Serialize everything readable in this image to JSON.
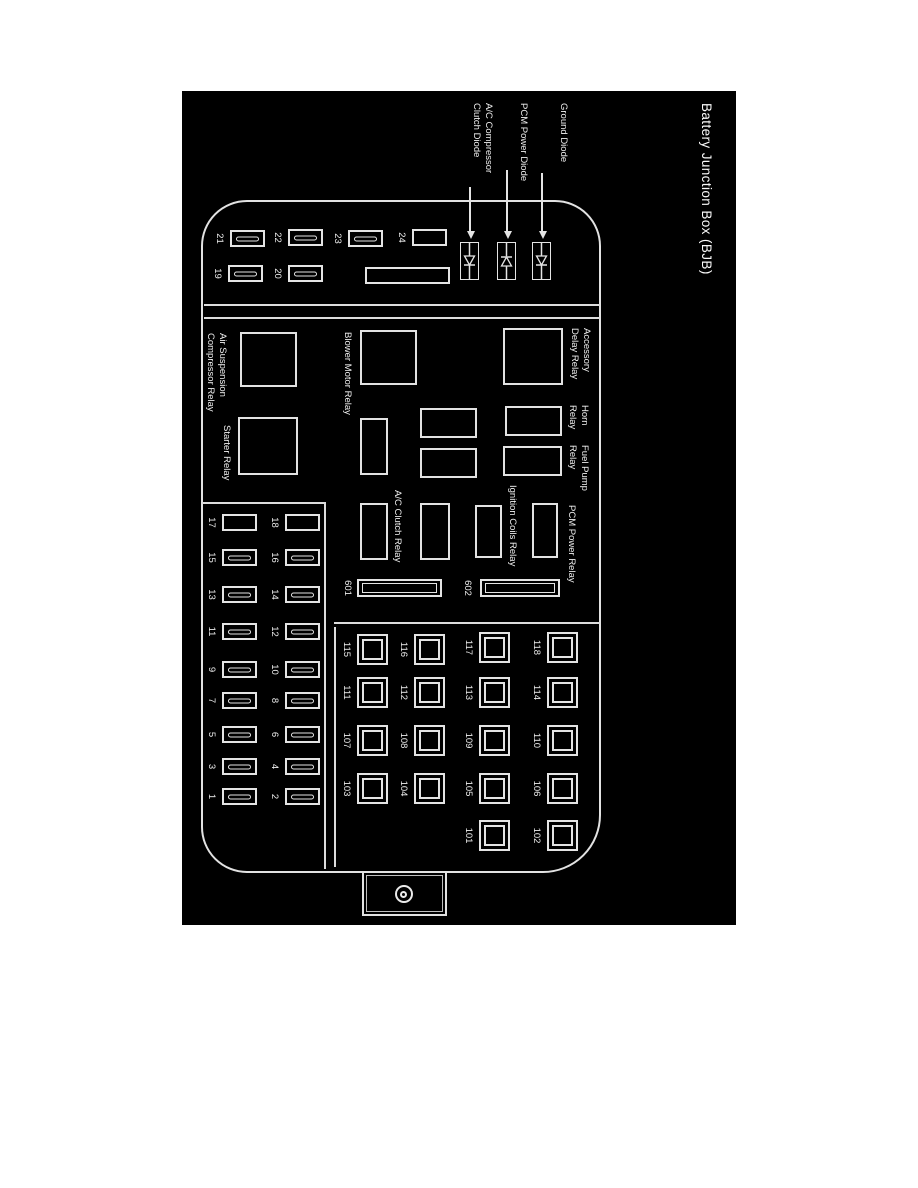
{
  "title": "Battery Junction Box (BJB)",
  "colors": {
    "background": "#000000",
    "line": "#e4e4e4",
    "text": "#f0f0f0"
  },
  "diode_callouts": {
    "ground": "Ground Diode",
    "pcm": "PCM Power Diode",
    "ac_line1": "A/C Compressor",
    "ac_line2": "Clutch Diode"
  },
  "relays": {
    "accessory_line1": "Accessory",
    "accessory_line2": "Delay Relay",
    "horn_line1": "Horn",
    "horn_line2": "Relay",
    "fuel_pump_line1": "Fuel Pump",
    "fuel_pump_line2": "Relay",
    "pcm_power": "PCM Power Relay",
    "ignition_coils": "Ignition Coils Relay",
    "ac_clutch": "A/C Clutch Relay",
    "blower_motor": "Blower Motor Relay",
    "starter": "Starter Relay",
    "air_suspension_line1": "Air Suspension",
    "air_suspension_line2": "Compressor Relay"
  },
  "cartridge_fuses": {
    "left": "601",
    "right": "602"
  },
  "top_fuses": {
    "f19": "19",
    "f20": "20",
    "f21": "21",
    "f22": "22",
    "f23": "23",
    "f24": "24"
  },
  "mini_fuses": {
    "even_row": [
      "18",
      "16",
      "14",
      "12",
      "10",
      "8",
      "6",
      "4",
      "2"
    ],
    "odd_row": [
      "17",
      "15",
      "13",
      "11",
      "9",
      "7",
      "5",
      "3",
      "1"
    ]
  },
  "square_fuses": {
    "row1": [
      "118",
      "114",
      "110",
      "106",
      "102"
    ],
    "row2": [
      "117",
      "113",
      "109",
      "105",
      "101"
    ],
    "row3": [
      "116",
      "112",
      "108",
      "104"
    ],
    "row4": [
      "115",
      "111",
      "107",
      "103"
    ]
  }
}
